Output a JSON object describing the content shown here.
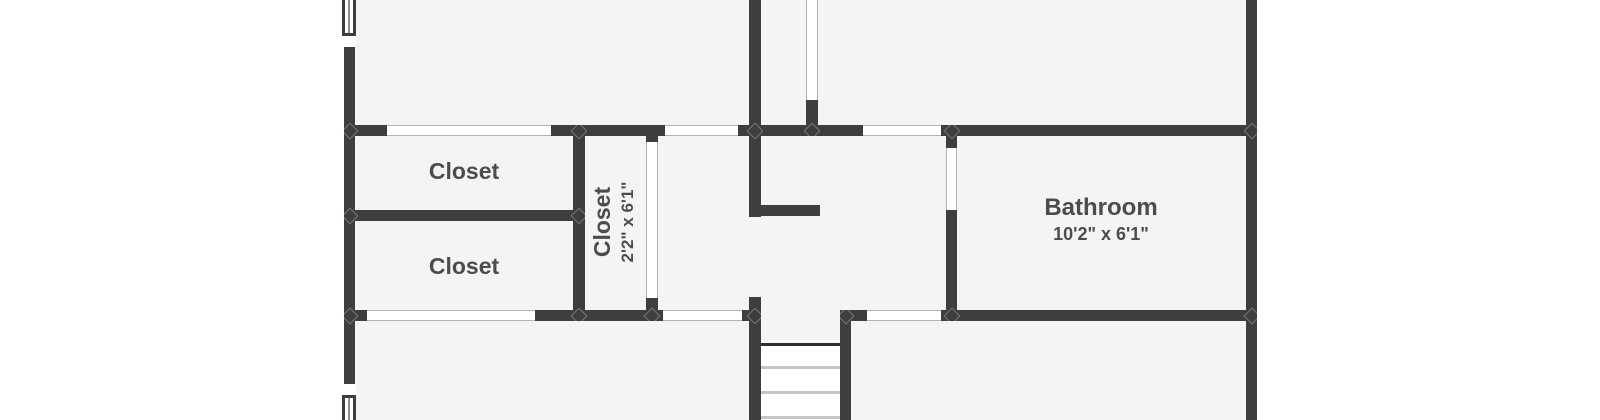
{
  "floor_plan": {
    "rooms": {
      "closet_top": {
        "label": "Closet"
      },
      "closet_bottom": {
        "label": "Closet"
      },
      "closet_hall": {
        "label": "Closet",
        "dimensions": "2'2\" x 6'1\""
      },
      "bathroom": {
        "label": "Bathroom",
        "dimensions": "10'2\" x 6'1\""
      }
    },
    "features": {
      "stairs": "staircase-going-down",
      "windows": [
        "left-wall-top-window",
        "left-wall-bottom-window"
      ],
      "door_openings_count": 9
    },
    "colors": {
      "wall": "#3e3e3e",
      "room_fill": "#f4f4f4",
      "background": "#ffffff",
      "label_text": "#4c4c4c",
      "opening_outline": "#b3b3b3",
      "stair_tread": "#c6c6c6",
      "stair_nosing": "#2e2e2e"
    }
  }
}
